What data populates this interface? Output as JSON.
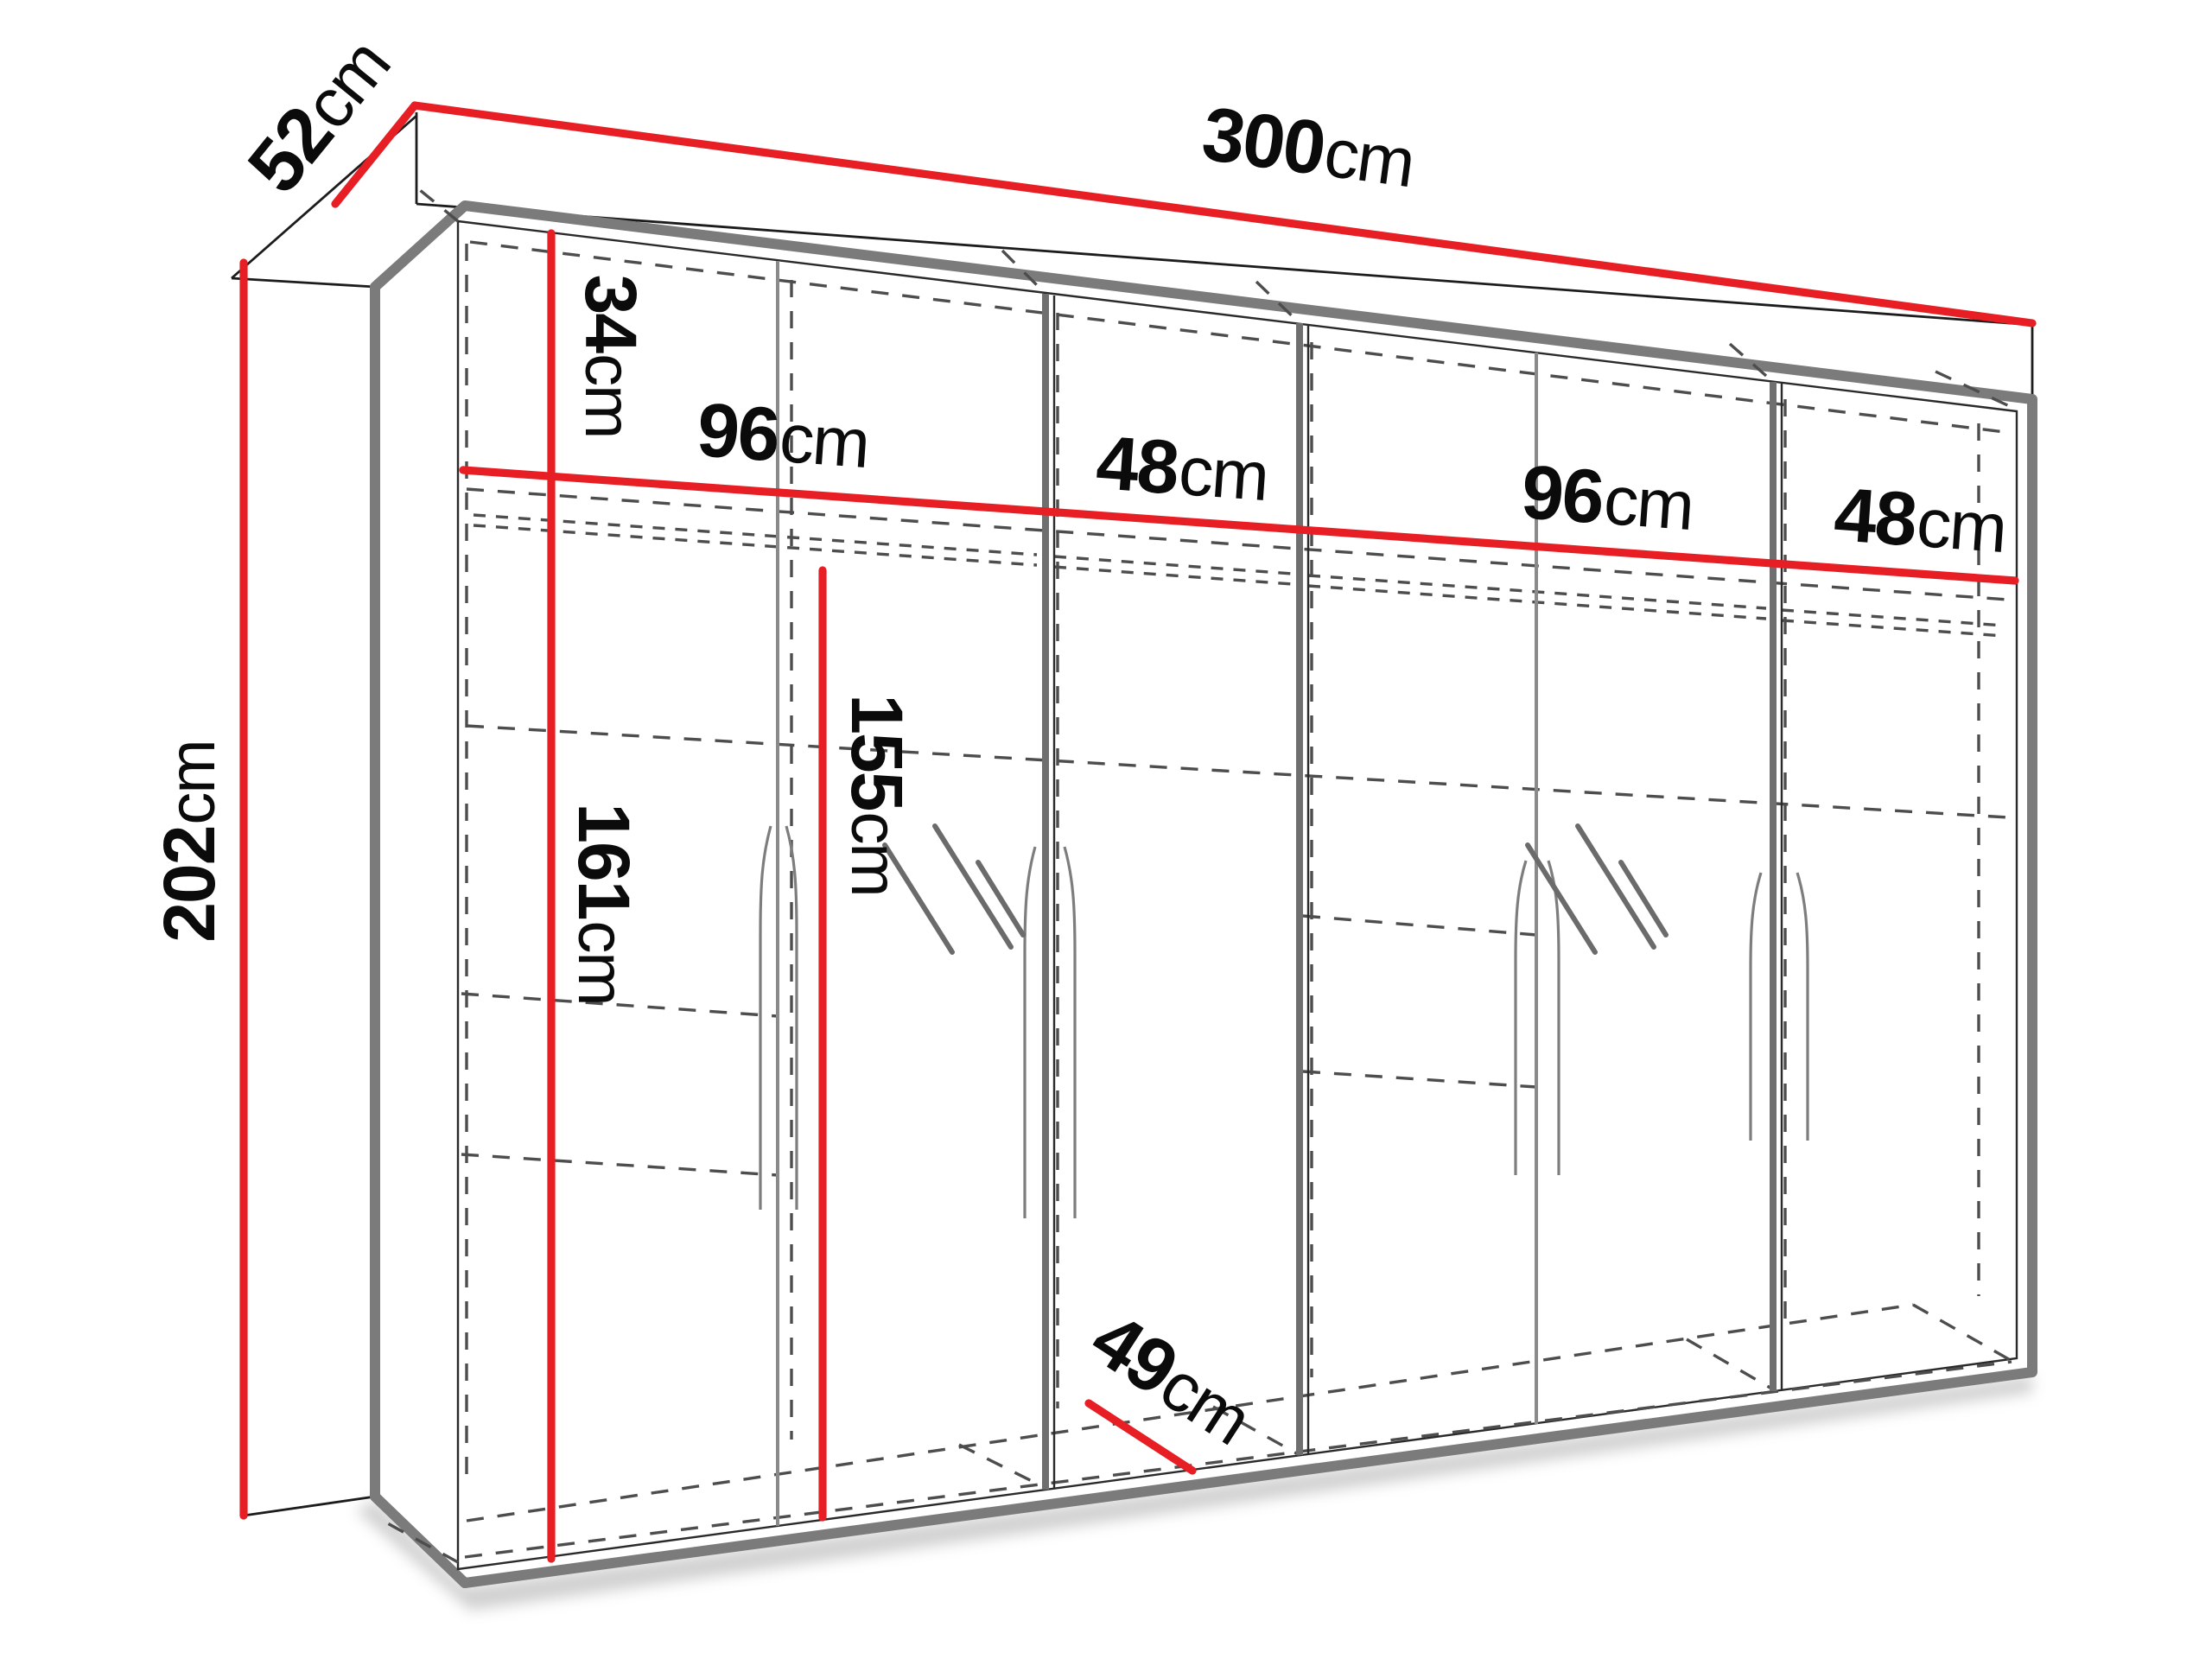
{
  "diagram": {
    "title": "wardrobe-dimension-diagram",
    "dimension_color": "#e81e25",
    "frame_color": "#7b7b7b",
    "dash_color": "#4d4d4d",
    "labels": {
      "width": {
        "value": "300",
        "unit": "cm"
      },
      "depth": {
        "value": "52",
        "unit": "cm"
      },
      "height": {
        "value": "202",
        "unit": "cm"
      },
      "top_shelf": {
        "value": "34",
        "unit": "cm"
      },
      "sections": [
        {
          "value": "96",
          "unit": "cm"
        },
        {
          "value": "48",
          "unit": "cm"
        },
        {
          "value": "96",
          "unit": "cm"
        },
        {
          "value": "48",
          "unit": "cm"
        }
      ],
      "hanging_left": {
        "value": "161",
        "unit": "cm"
      },
      "hanging_right": {
        "value": "155",
        "unit": "cm"
      },
      "inner_depth": {
        "value": "49",
        "unit": "cm"
      }
    }
  }
}
